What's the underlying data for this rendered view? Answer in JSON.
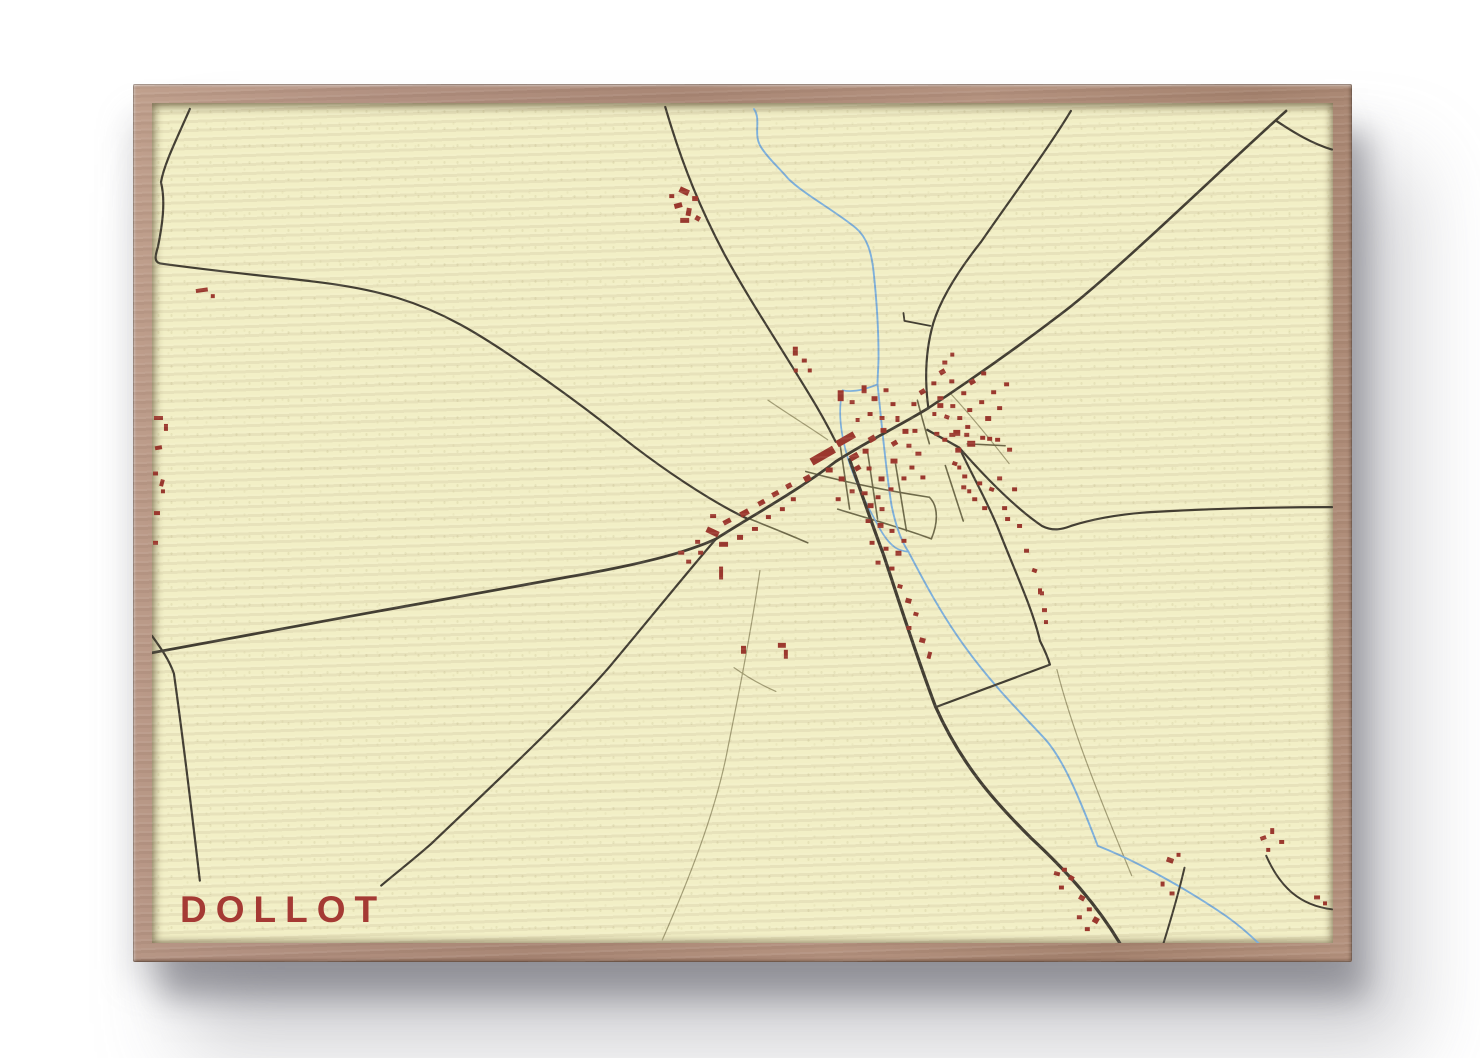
{
  "poster": {
    "title": "DOLLOT"
  },
  "colors": {
    "paper": "#f2efc6",
    "frame_wood": "#ad8b78",
    "road_major": "#423e33",
    "road_minor": "#6e6a4a",
    "path_faint": "#a29d74",
    "river": "#7db0dc",
    "building": "#9c382e",
    "title_text": "#a53a34",
    "page_background": "#ffffff"
  },
  "map": {
    "viewbox": "0 0 1185 848",
    "roads_major": [
      {
        "d": "M515,4 C533,66 552,110 574,152 C600,200 630,245 660,295 C668,308 678,326 686,342",
        "w": 2.2
      },
      {
        "d": "M922,8 C898,48 862,96 832,140 C810,168 792,196 784,222 C776,250 775,278 779,308",
        "w": 2.2
      },
      {
        "d": "M754,212 L755,220 L781,225",
        "w": 1.8
      },
      {
        "d": "M779,308 C824,278 872,244 916,210 C970,168 1080,60 1138,8",
        "w": 2.6
      },
      {
        "d": "M1128,18 C1146,30 1164,41 1184,47",
        "w": 2.2
      },
      {
        "d": "M0,555 C120,532 300,500 420,478 C500,464 540,452 566,440 C610,412 650,390 686,362 C720,340 750,326 779,308",
        "w": 2.8
      },
      {
        "d": "M38,6 C24,38 12,62 9,80 C14,100 10,125 6,145 C3,155 2,160 8,162 C80,172 130,176 160,180 C230,188 270,202 310,224 C350,246 420,296 470,336 C510,368 560,402 598,420",
        "w": 2.2
      },
      {
        "d": "M566,440 C540,470 500,520 460,568 C420,615 330,700 280,748 C262,764 244,778 230,790",
        "w": 2.2
      },
      {
        "d": "M0,538 C10,552 17,562 22,576 C32,648 40,716 48,785",
        "w": 2.2
      },
      {
        "d": "M700,360 C712,394 722,424 734,456 C748,498 764,550 786,609 C812,668 846,706 882,742 C914,772 946,806 971,848",
        "w": 3.2
      },
      {
        "d": "M778,330 C790,337 800,342 810,348",
        "w": 2.4
      },
      {
        "d": "M810,348 C824,378 840,406 850,432 C868,478 884,512 891,543 C896,553 899,560 901,567 L786,610",
        "w": 2.2
      },
      {
        "d": "M810,348 C838,380 868,410 893,427 C905,433 914,430 922,427 C947,419 972,415 1002,413 C1070,409 1130,408 1184,408",
        "w": 2.2
      },
      {
        "d": "M1036,772 C1030,798 1023,822 1015,848",
        "w": 2
      },
      {
        "d": "M1118,760 C1132,792 1152,810 1184,814",
        "w": 2
      }
    ],
    "roads_minor": [
      {
        "d": "M656,372 C700,384 740,392 780,398",
        "w": 1.6
      },
      {
        "d": "M690,342 L700,410",
        "w": 1.6
      },
      {
        "d": "M718,352 L728,420",
        "w": 1.6
      },
      {
        "d": "M746,364 L757,432",
        "w": 1.6
      },
      {
        "d": "M688,410 C720,420 750,428 782,440",
        "w": 1.6
      },
      {
        "d": "M780,398 C790,408 788,426 782,440",
        "w": 1.6
      },
      {
        "d": "M600,420 C620,428 640,436 658,444",
        "w": 1.6
      },
      {
        "d": "M768,300 C772,316 776,330 780,344",
        "w": 1.6
      },
      {
        "d": "M796,366 L814,422",
        "w": 1.6
      },
      {
        "d": "M818,344 L856,346",
        "w": 1.6
      }
    ],
    "paths_faint": [
      {
        "d": "M610,472 C600,540 588,600 578,650 C566,716 536,790 512,845",
        "w": 1.2
      },
      {
        "d": "M584,570 C598,580 612,588 626,594",
        "w": 1.2
      },
      {
        "d": "M908,572 C922,628 946,690 983,780",
        "w": 1.2
      },
      {
        "d": "M801,293 C824,318 843,342 860,364",
        "w": 1.2
      },
      {
        "d": "M618,300 C638,314 658,326 678,340",
        "w": 1.2
      }
    ],
    "rivers": [
      {
        "d": "M604,6 C612,18 602,32 612,46 C620,58 628,64 638,76 C654,92 684,108 706,126 C718,136 722,152 724,170 C727,198 729,228 729,256 C729,266 728,275 728,284 C732,322 736,368 742,406 C746,426 751,441 759,453 C774,482 792,516 815,548 C842,586 872,616 896,642 C914,662 930,700 949,750 C990,766 1042,796 1078,821 C1092,831 1102,840 1112,850",
        "w": 1.9
      },
      {
        "d": "M728,284 C714,290 702,292 693,290 C688,310 691,334 698,358 C706,384 718,408 731,431 C742,450 750,452 759,453",
        "w": 1.7
      }
    ],
    "buildings": [
      [
        529,
        86,
        10,
        6,
        25
      ],
      [
        542,
        94,
        6,
        5,
        0
      ],
      [
        524,
        101,
        8,
        5,
        -15
      ],
      [
        536,
        106,
        5,
        8,
        10
      ],
      [
        530,
        116,
        9,
        5,
        0
      ],
      [
        545,
        114,
        5,
        5,
        30
      ],
      [
        519,
        92,
        5,
        4,
        0
      ],
      [
        44,
        187,
        12,
        4,
        -8
      ],
      [
        59,
        193,
        4,
        4,
        0
      ],
      [
        2,
        316,
        9,
        4,
        0
      ],
      [
        12,
        324,
        4,
        7,
        0
      ],
      [
        3,
        346,
        7,
        4,
        -10
      ],
      [
        1,
        372,
        5,
        4,
        0
      ],
      [
        8,
        380,
        4,
        7,
        15
      ],
      [
        2,
        412,
        6,
        4,
        0
      ],
      [
        1,
        442,
        5,
        4,
        0
      ],
      [
        9,
        390,
        4,
        4,
        0
      ],
      [
        643,
        246,
        5,
        9,
        0
      ],
      [
        652,
        258,
        5,
        4,
        0
      ],
      [
        644,
        268,
        4,
        4,
        0
      ],
      [
        658,
        268,
        4,
        4,
        0
      ],
      [
        793,
        260,
        5,
        4,
        0
      ],
      [
        801,
        252,
        4,
        4,
        0
      ],
      [
        660,
        352,
        26,
        8,
        -30
      ],
      [
        686,
        336,
        20,
        7,
        -30
      ],
      [
        700,
        354,
        9,
        6,
        -30
      ],
      [
        676,
        368,
        7,
        5,
        0
      ],
      [
        689,
        377,
        6,
        5,
        0
      ],
      [
        705,
        366,
        6,
        5,
        -30
      ],
      [
        713,
        349,
        6,
        5,
        0
      ],
      [
        719,
        336,
        7,
        6,
        -30
      ],
      [
        731,
        328,
        6,
        5,
        0
      ],
      [
        717,
        367,
        5,
        4,
        0
      ],
      [
        729,
        377,
        6,
        5,
        0
      ],
      [
        741,
        359,
        7,
        5,
        0
      ],
      [
        742,
        341,
        6,
        5,
        -30
      ],
      [
        753,
        329,
        6,
        5,
        0
      ],
      [
        700,
        390,
        5,
        4,
        0
      ],
      [
        712,
        392,
        6,
        4,
        0
      ],
      [
        726,
        396,
        5,
        4,
        0
      ],
      [
        686,
        398,
        5,
        4,
        0
      ],
      [
        739,
        388,
        5,
        4,
        0
      ],
      [
        752,
        377,
        5,
        4,
        0
      ],
      [
        757,
        344,
        5,
        4,
        0
      ],
      [
        763,
        329,
        5,
        4,
        0
      ],
      [
        766,
        352,
        6,
        4,
        0
      ],
      [
        760,
        366,
        5,
        4,
        0
      ],
      [
        771,
        376,
        5,
        4,
        0
      ],
      [
        556,
        430,
        13,
        6,
        25
      ],
      [
        573,
        420,
        8,
        5,
        -28
      ],
      [
        590,
        411,
        9,
        6,
        -28
      ],
      [
        608,
        401,
        7,
        5,
        -28
      ],
      [
        560,
        415,
        6,
        4,
        0
      ],
      [
        545,
        441,
        5,
        4,
        0
      ],
      [
        569,
        443,
        9,
        5,
        0
      ],
      [
        587,
        436,
        6,
        5,
        0
      ],
      [
        602,
        428,
        6,
        4,
        0
      ],
      [
        622,
        392,
        7,
        5,
        -28
      ],
      [
        636,
        384,
        6,
        5,
        -28
      ],
      [
        641,
        398,
        5,
        4,
        0
      ],
      [
        654,
        376,
        7,
        6,
        -28
      ],
      [
        616,
        416,
        5,
        4,
        0
      ],
      [
        630,
        408,
        5,
        4,
        0
      ],
      [
        528,
        452,
        6,
        4,
        0
      ],
      [
        536,
        461,
        5,
        4,
        0
      ],
      [
        569,
        468,
        4,
        13,
        0
      ],
      [
        548,
        452,
        5,
        4,
        0
      ],
      [
        688,
        290,
        6,
        11,
        0
      ],
      [
        700,
        300,
        5,
        4,
        0
      ],
      [
        712,
        285,
        5,
        8,
        0
      ],
      [
        722,
        296,
        6,
        5,
        0
      ],
      [
        734,
        288,
        5,
        4,
        0
      ],
      [
        741,
        302,
        5,
        4,
        0
      ],
      [
        718,
        312,
        5,
        4,
        0
      ],
      [
        730,
        316,
        5,
        4,
        0
      ],
      [
        706,
        318,
        4,
        4,
        0
      ],
      [
        746,
        316,
        4,
        6,
        0
      ],
      [
        762,
        302,
        5,
        4,
        0
      ],
      [
        770,
        289,
        6,
        5,
        -30
      ],
      [
        782,
        281,
        5,
        4,
        0
      ],
      [
        790,
        269,
        6,
        5,
        -30
      ],
      [
        800,
        279,
        5,
        4,
        0
      ],
      [
        788,
        296,
        6,
        4,
        0
      ],
      [
        801,
        304,
        5,
        4,
        0
      ],
      [
        812,
        291,
        5,
        4,
        0
      ],
      [
        820,
        279,
        6,
        5,
        -30
      ],
      [
        832,
        271,
        5,
        4,
        0
      ],
      [
        808,
        316,
        5,
        4,
        0
      ],
      [
        818,
        308,
        5,
        4,
        0
      ],
      [
        830,
        300,
        5,
        4,
        0
      ],
      [
        842,
        290,
        5,
        4,
        0
      ],
      [
        836,
        316,
        6,
        5,
        0
      ],
      [
        848,
        306,
        5,
        4,
        0
      ],
      [
        855,
        282,
        5,
        4,
        0
      ],
      [
        804,
        330,
        7,
        6,
        0
      ],
      [
        816,
        325,
        5,
        4,
        0
      ],
      [
        806,
        348,
        6,
        5,
        0
      ],
      [
        818,
        341,
        8,
        6,
        0
      ],
      [
        831,
        336,
        5,
        4,
        0
      ],
      [
        812,
        386,
        5,
        4,
        0
      ],
      [
        846,
        338,
        5,
        4,
        0
      ],
      [
        858,
        348,
        5,
        4,
        0
      ],
      [
        788,
        303,
        6,
        5,
        0
      ],
      [
        795,
        315,
        5,
        4,
        20
      ],
      [
        783,
        312,
        4,
        4,
        0
      ],
      [
        785,
        332,
        5,
        4,
        0
      ],
      [
        793,
        338,
        5,
        4,
        0
      ],
      [
        800,
        333,
        6,
        4,
        0
      ],
      [
        815,
        333,
        5,
        4,
        0
      ],
      [
        838,
        337,
        5,
        4,
        0
      ],
      [
        803,
        362,
        5,
        4,
        20
      ],
      [
        808,
        366,
        4,
        4,
        0
      ],
      [
        813,
        375,
        5,
        4,
        0
      ],
      [
        828,
        382,
        5,
        4,
        0
      ],
      [
        840,
        388,
        5,
        4,
        20
      ],
      [
        848,
        377,
        5,
        4,
        0
      ],
      [
        818,
        390,
        4,
        4,
        0
      ],
      [
        823,
        398,
        5,
        4,
        0
      ],
      [
        833,
        407,
        5,
        4,
        0
      ],
      [
        853,
        407,
        5,
        4,
        0
      ],
      [
        863,
        388,
        5,
        4,
        0
      ],
      [
        856,
        418,
        5,
        4,
        0
      ],
      [
        868,
        425,
        5,
        4,
        0
      ],
      [
        875,
        450,
        5,
        4,
        0
      ],
      [
        883,
        470,
        5,
        4,
        20
      ],
      [
        889,
        490,
        4,
        6,
        0
      ],
      [
        893,
        510,
        5,
        4,
        0
      ],
      [
        891,
        493,
        4,
        4,
        0
      ],
      [
        895,
        522,
        4,
        4,
        0
      ],
      [
        718,
        404,
        6,
        5,
        0
      ],
      [
        730,
        408,
        5,
        4,
        0
      ],
      [
        716,
        420,
        5,
        4,
        0
      ],
      [
        728,
        424,
        6,
        5,
        0
      ],
      [
        740,
        430,
        5,
        4,
        0
      ],
      [
        720,
        442,
        5,
        4,
        0
      ],
      [
        734,
        448,
        5,
        4,
        0
      ],
      [
        746,
        452,
        6,
        5,
        0
      ],
      [
        726,
        462,
        5,
        4,
        0
      ],
      [
        740,
        468,
        5,
        4,
        0
      ],
      [
        752,
        440,
        5,
        4,
        0
      ],
      [
        748,
        486,
        5,
        4,
        15
      ],
      [
        756,
        500,
        6,
        5,
        15
      ],
      [
        764,
        514,
        5,
        4,
        15
      ],
      [
        757,
        528,
        5,
        4,
        0
      ],
      [
        770,
        540,
        6,
        5,
        15
      ],
      [
        778,
        554,
        4,
        7,
        15
      ],
      [
        591,
        548,
        5,
        8,
        0
      ],
      [
        628,
        545,
        8,
        5,
        0
      ],
      [
        634,
        552,
        4,
        9,
        0
      ],
      [
        905,
        776,
        6,
        4,
        15
      ],
      [
        913,
        772,
        5,
        4,
        0
      ],
      [
        920,
        780,
        5,
        5,
        30
      ],
      [
        910,
        790,
        5,
        4,
        0
      ],
      [
        930,
        800,
        6,
        5,
        30
      ],
      [
        938,
        812,
        5,
        4,
        0
      ],
      [
        928,
        820,
        5,
        4,
        0
      ],
      [
        944,
        822,
        6,
        6,
        30
      ],
      [
        936,
        832,
        5,
        4,
        0
      ],
      [
        1018,
        762,
        7,
        5,
        20
      ],
      [
        1028,
        757,
        4,
        4,
        0
      ],
      [
        1012,
        786,
        4,
        5,
        0
      ],
      [
        1021,
        796,
        5,
        4,
        0
      ],
      [
        1112,
        740,
        6,
        4,
        -20
      ],
      [
        1122,
        732,
        4,
        6,
        0
      ],
      [
        1131,
        744,
        5,
        4,
        0
      ],
      [
        1118,
        752,
        4,
        4,
        0
      ],
      [
        1166,
        800,
        6,
        4,
        0
      ],
      [
        1175,
        806,
        4,
        4,
        0
      ]
    ]
  }
}
